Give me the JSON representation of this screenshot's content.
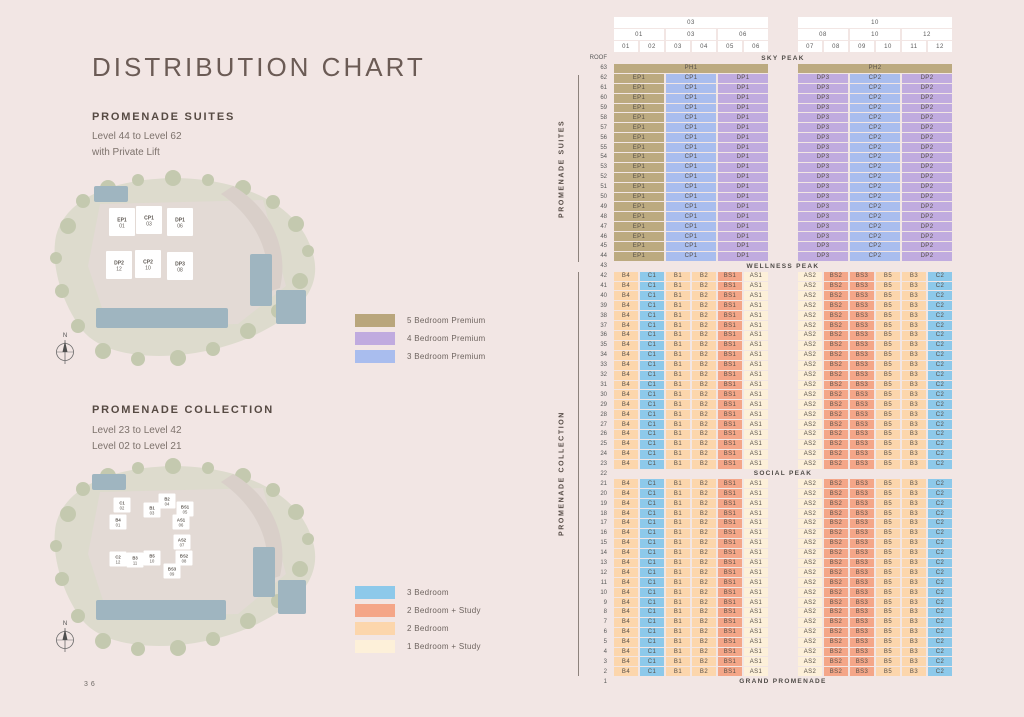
{
  "page": {
    "number": "36",
    "background": "#f2e6e4"
  },
  "header": {
    "title": "DISTRIBUTION CHART"
  },
  "suites_section": {
    "heading": "PROMENADE SUITES",
    "line1": "Level 44 to Level 62",
    "line2": "with Private Lift",
    "compass_n": "N",
    "legend": [
      {
        "label": "5 Bedroom Premium",
        "color": "#b9a67c"
      },
      {
        "label": "4 Bedroom Premium",
        "color": "#c0abdf"
      },
      {
        "label": "3 Bedroom Premium",
        "color": "#a9bdee"
      }
    ],
    "siteplan_buildings": [
      {
        "code": "EP1",
        "stack": "01"
      },
      {
        "code": "CP1",
        "stack": "03"
      },
      {
        "code": "DP1",
        "stack": "06"
      },
      {
        "code": "DP2",
        "stack": "12"
      },
      {
        "code": "CP2",
        "stack": "10"
      },
      {
        "code": "DP3",
        "stack": "08"
      }
    ]
  },
  "collection_section": {
    "heading": "PROMENADE COLLECTION",
    "line1": "Level 23 to Level 42",
    "line2": "Level 02 to Level 21",
    "compass_n": "N",
    "legend": [
      {
        "label": "3 Bedroom",
        "color": "#8dc9ea"
      },
      {
        "label": "2 Bedroom + Study",
        "color": "#f4a688"
      },
      {
        "label": "2 Bedroom",
        "color": "#fcd6ac"
      },
      {
        "label": "1 Bedroom + Study",
        "color": "#fdf0d9"
      }
    ],
    "siteplan_buildings": [
      {
        "code": "C1",
        "stack": "02"
      },
      {
        "code": "B1",
        "stack": "03"
      },
      {
        "code": "B2",
        "stack": "04"
      },
      {
        "code": "BS1",
        "stack": "05"
      },
      {
        "code": "B4",
        "stack": "01"
      },
      {
        "code": "AS1",
        "stack": "06"
      },
      {
        "code": "AS2",
        "stack": "07"
      },
      {
        "code": "C2",
        "stack": "12"
      },
      {
        "code": "B3",
        "stack": "11"
      },
      {
        "code": "B5",
        "stack": "10"
      },
      {
        "code": "BS2",
        "stack": "08"
      },
      {
        "code": "BS3",
        "stack": "09"
      }
    ]
  },
  "table_labels": {
    "suites_side": "PROMENADE SUITES",
    "collection_side": "PROMENADE COLLECTION",
    "roof": "ROOF",
    "sky_peak": "SKY PEAK",
    "wellness_peak": "WELLNESS PEAK",
    "social_peak": "SOCIAL PEAK",
    "grand_promenade": "GRAND PROMENADE"
  },
  "chart_data": {
    "type": "table",
    "title": "DISTRIBUTION CHART",
    "stacks": [
      "01",
      "02",
      "03",
      "04",
      "05",
      "06",
      "07",
      "08",
      "09",
      "10",
      "11",
      "12"
    ],
    "stack_header_row1": [
      {
        "label": "03",
        "stacks": [
          1,
          6
        ]
      },
      {
        "label": "10",
        "stacks": [
          7,
          12
        ]
      }
    ],
    "stack_header_row2": [
      {
        "label": "01",
        "stacks": [
          1,
          2
        ]
      },
      {
        "label": "03",
        "stacks": [
          3,
          4
        ]
      },
      {
        "label": "06",
        "stacks": [
          5,
          6
        ]
      },
      {
        "label": "08",
        "stacks": [
          7,
          8
        ]
      },
      {
        "label": "10",
        "stacks": [
          9,
          10
        ]
      },
      {
        "label": "12",
        "stacks": [
          11,
          12
        ]
      }
    ],
    "categories": {
      "tan": {
        "label": "5 Bedroom Premium",
        "color": "#bcaa80"
      },
      "purple": {
        "label": "4 Bedroom Premium",
        "color": "#c0abdf"
      },
      "pblue": {
        "label": "3 Bedroom Premium",
        "color": "#a9bdee"
      },
      "blue": {
        "label": "3 Bedroom",
        "color": "#8dc9ea"
      },
      "salmon": {
        "label": "2 Bedroom + Study",
        "color": "#f4a688"
      },
      "peach": {
        "label": "2 Bedroom",
        "color": "#fcd6ac"
      },
      "cream": {
        "label": "1 Bedroom + Study",
        "color": "#fdf0d9"
      }
    },
    "unit_category": {
      "PH1": "tan",
      "PH2": "tan",
      "EP1": "tan",
      "CP1": "pblue",
      "CP2": "pblue",
      "DP1": "purple",
      "DP2": "purple",
      "DP3": "purple",
      "B1": "peach",
      "B2": "peach",
      "B3": "peach",
      "B4": "peach",
      "B5": "peach",
      "C1": "blue",
      "C2": "blue",
      "BS1": "salmon",
      "BS2": "salmon",
      "BS3": "salmon",
      "AS1": "cream",
      "AS2": "cream"
    },
    "row_patterns": {
      "ph": [
        {
          "unit": "PH1",
          "start": 1,
          "span": 6
        },
        {
          "unit": "PH2",
          "start": 7,
          "span": 6
        }
      ],
      "suites": [
        {
          "unit": "EP1",
          "start": 1,
          "span": 2
        },
        {
          "unit": "CP1",
          "start": 3,
          "span": 2
        },
        {
          "unit": "DP1",
          "start": 5,
          "span": 2
        },
        {
          "unit": "DP3",
          "start": 7,
          "span": 2
        },
        {
          "unit": "CP2",
          "start": 9,
          "span": 2
        },
        {
          "unit": "DP2",
          "start": 11,
          "span": 2
        }
      ],
      "collection": [
        {
          "unit": "B4",
          "start": 1,
          "span": 1
        },
        {
          "unit": "C1",
          "start": 2,
          "span": 1
        },
        {
          "unit": "B1",
          "start": 3,
          "span": 1
        },
        {
          "unit": "B2",
          "start": 4,
          "span": 1
        },
        {
          "unit": "BS1",
          "start": 5,
          "span": 1
        },
        {
          "unit": "AS1",
          "start": 6,
          "span": 1
        },
        {
          "unit": "AS2",
          "start": 7,
          "span": 1
        },
        {
          "unit": "BS2",
          "start": 8,
          "span": 1
        },
        {
          "unit": "BS3",
          "start": 9,
          "span": 1
        },
        {
          "unit": "B5",
          "start": 10,
          "span": 1
        },
        {
          "unit": "B3",
          "start": 11,
          "span": 1
        },
        {
          "unit": "C2",
          "start": 12,
          "span": 1
        }
      ]
    },
    "floor_rows": [
      {
        "floor": 63,
        "pattern": "ph"
      },
      {
        "from": 62,
        "to": 44,
        "pattern": "suites"
      },
      {
        "floor": 43,
        "label": "WELLNESS PEAK"
      },
      {
        "from": 42,
        "to": 23,
        "pattern": "collection"
      },
      {
        "floor": 22,
        "label": "SOCIAL PEAK"
      },
      {
        "from": 21,
        "to": 2,
        "pattern": "collection"
      },
      {
        "floor": 1,
        "label": "GRAND PROMENADE"
      }
    ]
  }
}
